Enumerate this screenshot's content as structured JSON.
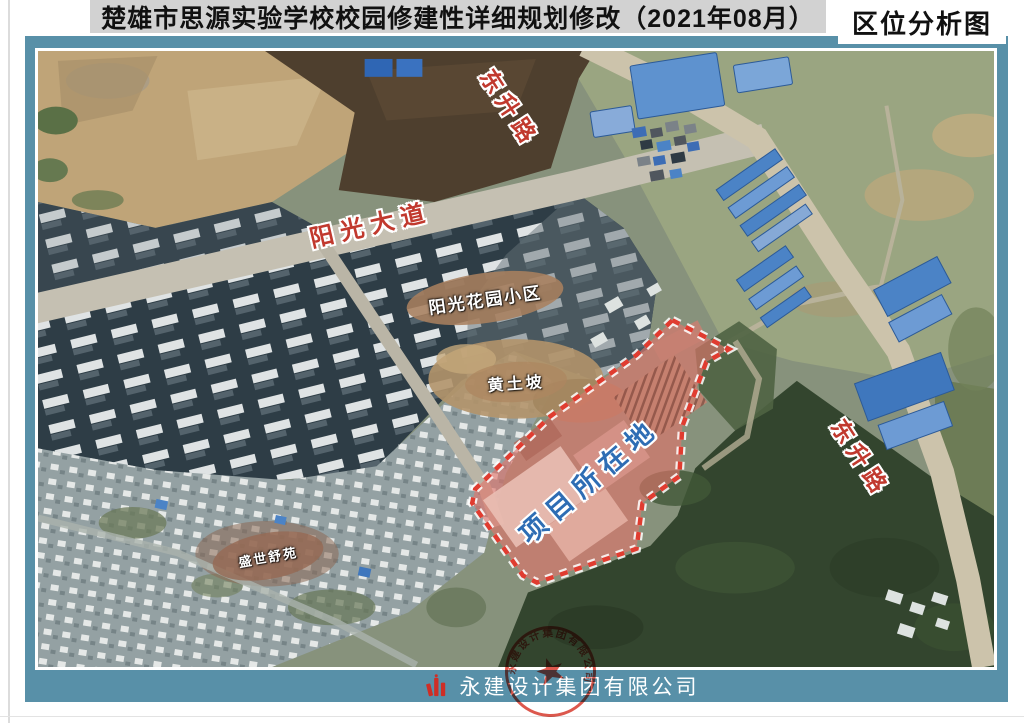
{
  "header": {
    "title": "楚雄市思源实验学校校园修建性详细规划修改（2021年08月）",
    "corner_label": "区位分析图"
  },
  "map": {
    "road_labels": {
      "dongsheng_top": "东升路",
      "yangguang_avenue": "阳光大道",
      "dongsheng_right": "东升路"
    },
    "area_labels": {
      "yangguang_garden": "阳光花园小区",
      "huangtupo": "黄土坡",
      "shengshi": "盛世舒苑"
    },
    "project_label": "项目所在地"
  },
  "footer": {
    "company_name": "永建设计集团有限公司",
    "seal_text": "永建设计集团有限公司"
  },
  "colors": {
    "frame_teal": "#5890a8",
    "title_bar_gray": "#d2d2d2",
    "road_label_red": "#c1392e",
    "project_fill_red": "#e2756a",
    "project_border_red": "#e03c30",
    "project_label_blue": "#2e6db4",
    "area_oval_tan": "#a97f5f",
    "seal_red": "#d63a2e"
  }
}
